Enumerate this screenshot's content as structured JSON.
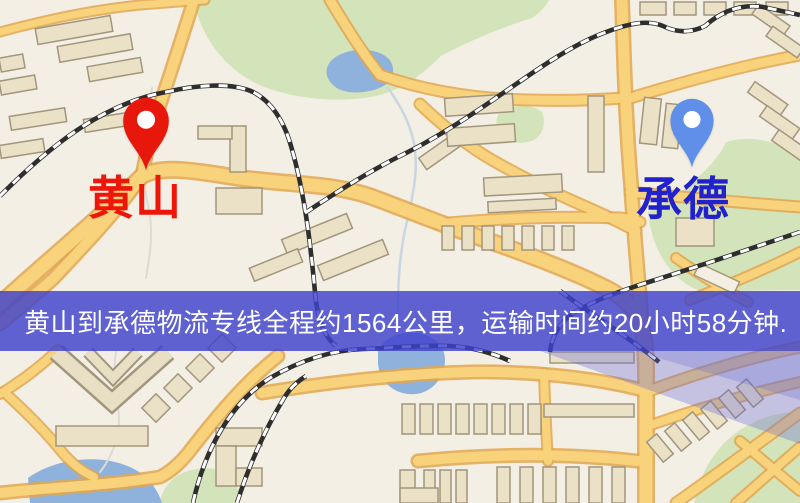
{
  "banner": {
    "text": "黄山到承德物流专线全程约1564公里，运输时间约20小时58分钟.",
    "bg_color": "#3e42cd",
    "text_color": "#ffffff"
  },
  "pins": {
    "origin": {
      "label": "黄山",
      "pin_color": "#e8170c",
      "label_color": "#ee1509"
    },
    "destination": {
      "label": "承德",
      "pin_color": "#5f8fe8",
      "label_color": "#2222cc"
    }
  },
  "map_palette": {
    "background": "#f3efe4",
    "road": "#f8d37c",
    "road_casing": "#e2a64d",
    "park": "#d4e4ba",
    "water": "#8fb2dc",
    "building": "#ebe1c6",
    "railway": "#2e2e2e"
  }
}
